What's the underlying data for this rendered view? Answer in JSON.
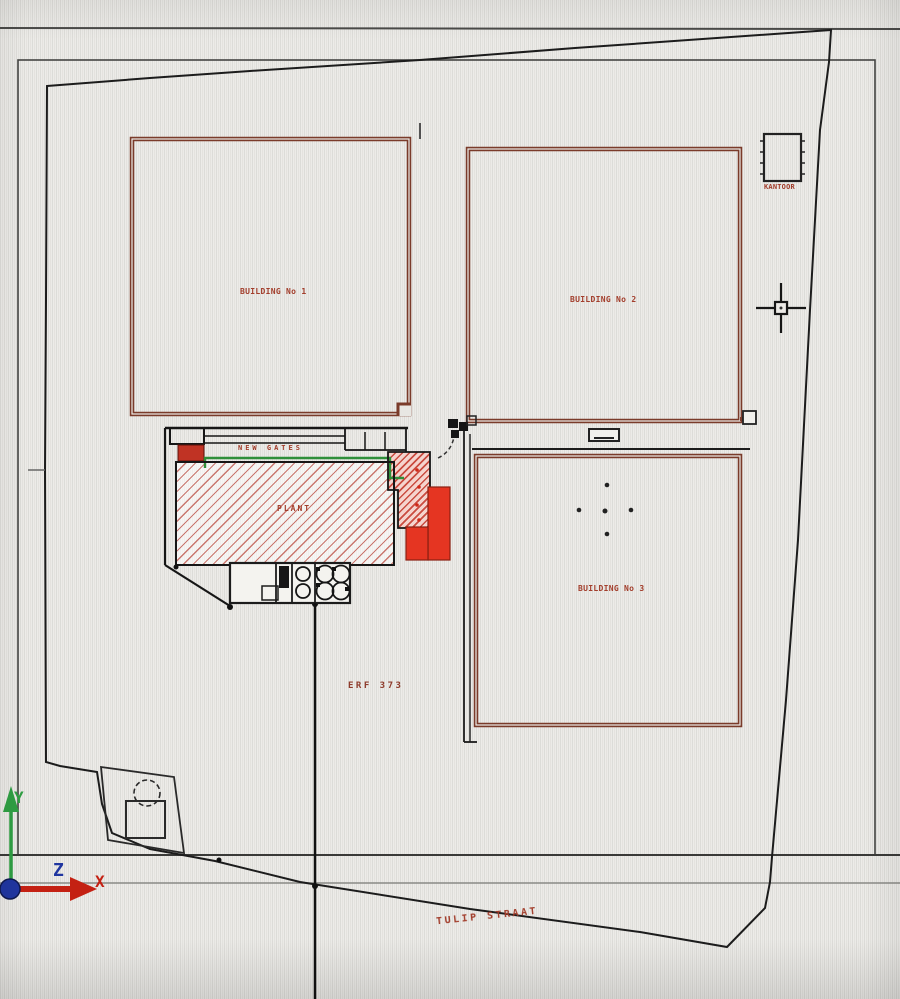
{
  "site_plan": {
    "buildings": [
      {
        "label": "BUILDING No 1"
      },
      {
        "label": "BUILDING No 2"
      },
      {
        "label": "BUILDING No 3"
      }
    ],
    "annotations": {
      "new_gates": "NEW GATES",
      "plant": "PLANT",
      "erf": "ERF 373",
      "street": "TULIP STRAAT",
      "kantoor": "KANTOOR"
    },
    "ucs": {
      "x_label": "X",
      "y_label": "Y",
      "z_label": "Z"
    },
    "colors": {
      "wall_maroon": "#7a3b2a",
      "hatch_red": "#bb4d42",
      "solid_red": "#e53522",
      "green_line": "#2f8f3a",
      "label_red": "#a23d2b",
      "axis_x_red": "#c42113",
      "axis_y_green": "#2f9e43",
      "axis_z_blue": "#2036a0"
    }
  }
}
